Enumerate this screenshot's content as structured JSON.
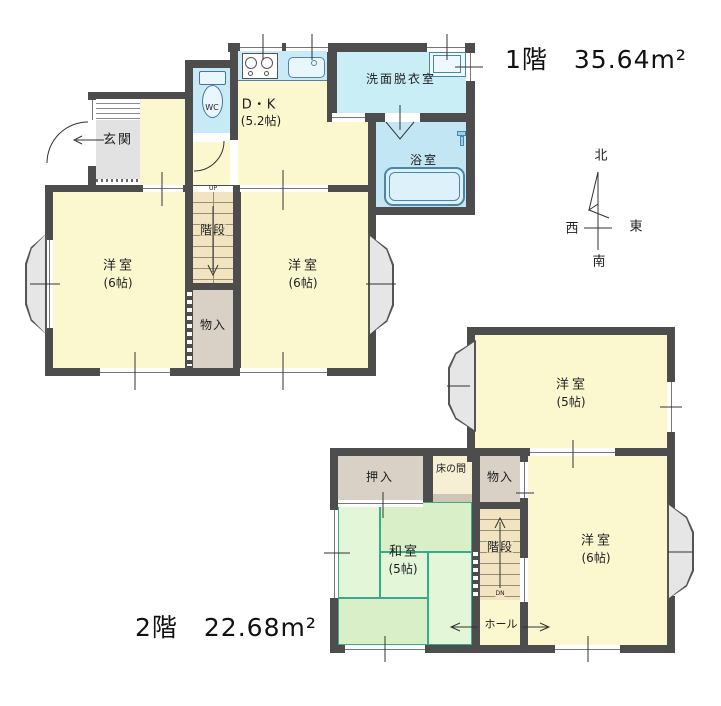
{
  "colors": {
    "wall": "#4d4d4d",
    "room_yellow": "#fbf8d0",
    "water_blue": "#c9eaf8",
    "bath_blue": "#c3e6f4",
    "tatami_green": "#dff2d2",
    "tatami_line": "#3aab8a",
    "storage_tan": "#d9d1c5",
    "stairs_beige": "#f2e4c0",
    "entry_gray": "#e2e2e2",
    "fixture_line": "#4a85aa"
  },
  "floor1": {
    "title": "1階　35.64m²",
    "genkan": "玄関",
    "wc": "WC",
    "dk_name": "D・K",
    "dk_size": "(5.2帖)",
    "washroom": "洗面脱衣室",
    "bath": "浴室",
    "stairs": "階段",
    "up": "UP",
    "storage": "物入",
    "west_room_name": "洋室",
    "west_room_size": "(6帖)",
    "east_room_name": "洋室",
    "east_room_size": "(6帖)"
  },
  "floor2": {
    "title": "2階　22.68m²",
    "room5_name": "洋室",
    "room5_size": "(5帖)",
    "oshiire": "押入",
    "tokonoma": "床の間",
    "storage": "物入",
    "washitsu_name": "和室",
    "washitsu_size": "(5帖)",
    "stairs": "階段",
    "dn": "DN",
    "hall": "ホール",
    "room6_name": "洋室",
    "room6_size": "(6帖)"
  },
  "compass": {
    "north": "北",
    "south": "南",
    "east": "東",
    "west": "西"
  }
}
